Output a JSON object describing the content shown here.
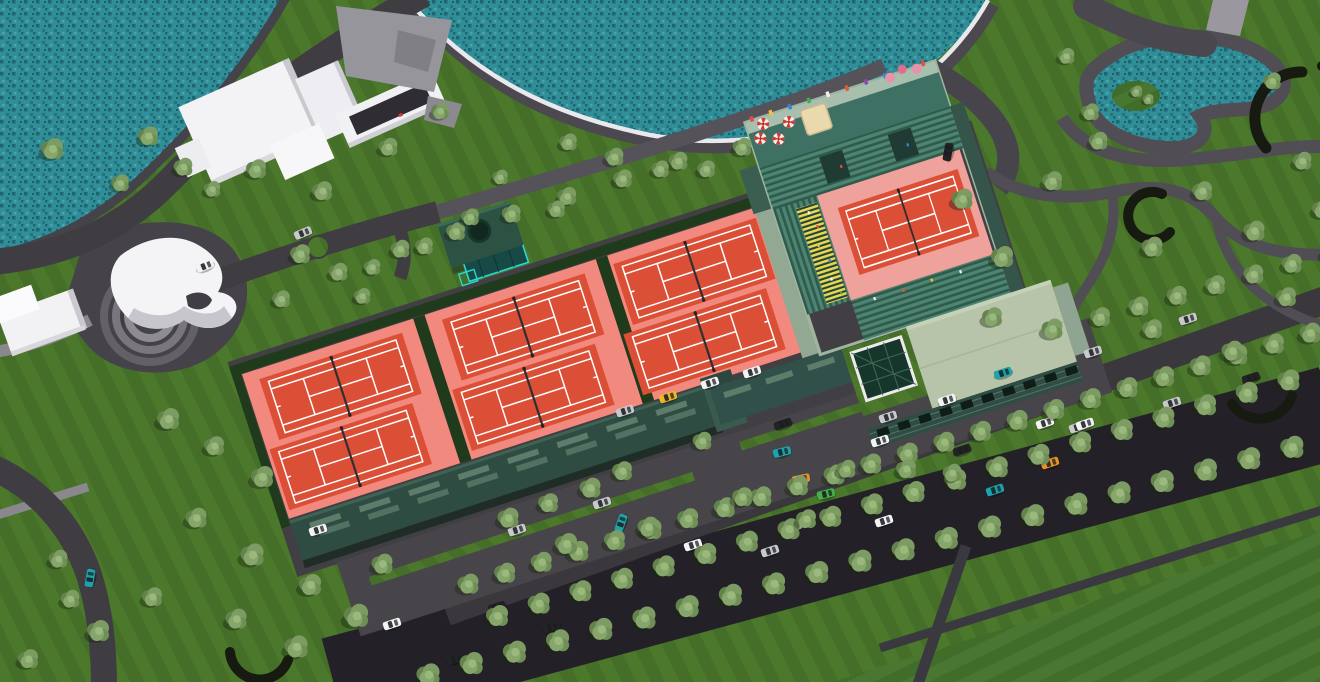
{
  "meta": {
    "description": "Aerial 3D architectural rendering of a lakeside tennis club complex",
    "view": "bird's-eye perspective, no visible text"
  },
  "palette": {
    "lawn": "#4c782c",
    "lawn-dark": "#456f28",
    "water": "#2f8e98",
    "water-dark": "#206570",
    "water-light": "#49a4ab",
    "pad": "#f2897e",
    "stadium-pad": "#efa19b",
    "court-red": "#dc4f37",
    "line": "#ffffff",
    "road": "#3f3d42",
    "boulevard": "#232127",
    "service": "#3a383d",
    "path": "#56525a",
    "path-light": "#9a989e",
    "walk": "#4b494f",
    "curb": "#e9e9ed",
    "plaza": "#454349",
    "hedge": "#203a1c",
    "arc": "#161a10",
    "stand": "#47806e",
    "terrace": "#3e7163",
    "terrace-walk": "#a9bfae",
    "stair": "#e7d84f",
    "roof-pale": "#b7c4a9",
    "facade": "#2f4d44",
    "indoor-roof": "#2f4c42",
    "slat": "#5d7c6a",
    "wall-light": "#93a893",
    "skylight": "#17362b",
    "teal": "#29d8d2",
    "white-bldg": "#f3f3f5",
    "white-shade": "#c9c9cf",
    "concrete": "#96959b",
    "tent": "#ead9ac",
    "car_colors": {
      "w": "#f2f3f5",
      "s": "#c8c9ce",
      "b": "#232327",
      "t": "#1ba4ac",
      "o": "#e8912a",
      "y": "#f0b42a",
      "g": "#43b04a"
    }
  },
  "scene": {
    "courts": {
      "outdoor_pads": 3,
      "courts_per_pad": 2,
      "outdoor_courts": 6,
      "stadium_courts": 1,
      "total_courts": 7
    },
    "water_features": [
      "large lake top",
      "corner lake top-left",
      "kidney pond with island top-right"
    ],
    "buildings": [
      "white villa cluster",
      "white sculptural pavilion with ring steps",
      "gray service slab",
      "indoor courts hall",
      "green-roof clubhouse with pyramid skylight",
      "entrance pavilion with round roof opening",
      "stadium with teal stands"
    ],
    "stadium": {
      "flag_colors": [
        "#e64b3c",
        "#f2c335",
        "#2e86d4",
        "#3fae4a",
        "#f0eff2",
        "#e2572f",
        "#8e44ad",
        "#2e86d4",
        "#f2c335",
        "#e64b3c"
      ],
      "umbrellas": [
        [
          826,
          168
        ],
        [
          843,
          174
        ],
        [
          858,
          161
        ],
        [
          833,
          155
        ]
      ],
      "flower_pots": [
        [
          968,
          150
        ],
        [
          982,
          146
        ],
        [
          996,
          150
        ]
      ],
      "crowd": [
        [
          848,
          252,
          "#f2f3f5"
        ],
        [
          852,
          268,
          "#e64b3c"
        ],
        [
          847,
          286,
          "#f2c335"
        ],
        [
          853,
          304,
          "#2e86d4"
        ],
        [
          849,
          322,
          "#f2f3f5"
        ],
        [
          854,
          338,
          "#3fae4a"
        ],
        [
          884,
          354,
          "#f2f3f5"
        ],
        [
          914,
          355,
          "#e2572f"
        ],
        [
          944,
          354,
          "#f2c335"
        ],
        [
          974,
          355,
          "#f2f3f5"
        ],
        [
          893,
          218,
          "#e64b3c"
        ],
        [
          963,
          218,
          "#2e86d4"
        ]
      ]
    },
    "tree_rows": [
      {
        "from": [
          497,
          617
        ],
        "to": [
          1330,
          369
        ],
        "n": 21,
        "s": 1.0
      },
      {
        "from": [
          428,
          676
        ],
        "to": [
          1335,
          437
        ],
        "n": 22,
        "s": 1.05
      },
      {
        "from": [
          468,
          585
        ],
        "to": [
          1310,
          334
        ],
        "n": 24,
        "s": 0.95
      },
      {
        "from": [
          400,
          250
        ],
        "to": [
          678,
          162
        ],
        "n": 6,
        "s": 0.85
      },
      {
        "from": [
          1100,
          318
        ],
        "to": [
          1330,
          254
        ],
        "n": 7,
        "s": 0.9
      }
    ],
    "trees_scatter": [
      [
        52,
        150,
        1
      ],
      [
        148,
        137,
        0.9
      ],
      [
        183,
        168,
        0.85
      ],
      [
        256,
        170,
        0.9
      ],
      [
        322,
        192,
        0.9
      ],
      [
        388,
        148,
        0.85
      ],
      [
        440,
        112,
        0.8
      ],
      [
        300,
        255,
        0.9
      ],
      [
        338,
        273,
        0.85
      ],
      [
        281,
        300,
        0.8
      ],
      [
        362,
        297,
        0.75
      ],
      [
        470,
        218,
        0.8
      ],
      [
        424,
        247,
        0.8
      ],
      [
        372,
        268,
        0.75
      ],
      [
        120,
        184,
        0.8
      ],
      [
        212,
        190,
        0.75
      ],
      [
        568,
        143,
        0.8
      ],
      [
        614,
        158,
        0.85
      ],
      [
        660,
        170,
        0.8
      ],
      [
        742,
        148,
        0.85
      ],
      [
        706,
        170,
        0.8
      ],
      [
        168,
        420,
        1
      ],
      [
        214,
        447,
        0.9
      ],
      [
        262,
        478,
        1
      ],
      [
        196,
        519,
        0.95
      ],
      [
        252,
        556,
        1.05
      ],
      [
        310,
        586,
        1
      ],
      [
        356,
        617,
        1.1
      ],
      [
        296,
        648,
        1.05
      ],
      [
        236,
        620,
        0.95
      ],
      [
        152,
        598,
        0.9
      ],
      [
        98,
        632,
        1
      ],
      [
        382,
        565,
        0.95
      ],
      [
        58,
        560,
        0.85
      ],
      [
        28,
        660,
        0.9
      ],
      [
        70,
        600,
        0.85
      ],
      [
        508,
        519,
        0.95
      ],
      [
        548,
        504,
        0.9
      ],
      [
        590,
        489,
        0.95
      ],
      [
        566,
        545,
        1
      ],
      [
        622,
        472,
        0.9
      ],
      [
        702,
        442,
        0.85
      ],
      [
        648,
        528,
        0.95
      ],
      [
        742,
        498,
        0.9
      ],
      [
        806,
        520,
        0.9
      ],
      [
        846,
        470,
        0.85
      ],
      [
        906,
        470,
        0.9
      ],
      [
        952,
        474,
        0.85
      ],
      [
        962,
        200,
        0.95
      ],
      [
        1002,
        258,
        1
      ],
      [
        1052,
        182,
        0.9
      ],
      [
        1098,
        142,
        0.85
      ],
      [
        1152,
        248,
        0.95
      ],
      [
        1202,
        192,
        0.9
      ],
      [
        1254,
        232,
        0.95
      ],
      [
        1286,
        298,
        0.9
      ],
      [
        1232,
        352,
        0.95
      ],
      [
        1152,
        330,
        0.9
      ],
      [
        1052,
        330,
        0.95
      ],
      [
        992,
        318,
        0.9
      ],
      [
        1302,
        162,
        0.85
      ],
      [
        1272,
        82,
        0.8
      ],
      [
        1066,
        57,
        0.75
      ],
      [
        1090,
        113,
        0.8
      ],
      [
        1322,
        210,
        0.9
      ],
      [
        1136,
        92,
        0.55
      ],
      [
        1148,
        100,
        0.5
      ],
      [
        500,
        178,
        0.7
      ],
      [
        556,
        210,
        0.8
      ]
    ],
    "cars": [
      [
        205,
        266,
        -23,
        "w"
      ],
      [
        303,
        233,
        -23,
        "s"
      ],
      [
        948,
        152,
        -80,
        "b"
      ],
      [
        318,
        530,
        -17,
        "w"
      ],
      [
        90,
        578,
        -80,
        "t"
      ],
      [
        625,
        411,
        -18,
        "s"
      ],
      [
        668,
        397,
        -18,
        "y"
      ],
      [
        710,
        383,
        -18,
        "w"
      ],
      [
        752,
        372,
        -18,
        "w"
      ],
      [
        783,
        424,
        -18,
        "b"
      ],
      [
        782,
        452,
        -14,
        "t"
      ],
      [
        801,
        479,
        -12,
        "o"
      ],
      [
        826,
        494,
        -14,
        "g"
      ],
      [
        602,
        503,
        -18,
        "s"
      ],
      [
        621,
        523,
        -70,
        "t"
      ],
      [
        517,
        530,
        -18,
        "s"
      ],
      [
        693,
        545,
        -18,
        "w"
      ],
      [
        770,
        551,
        -18,
        "s"
      ],
      [
        793,
        527,
        -18,
        "w"
      ],
      [
        884,
        521,
        -18,
        "w"
      ],
      [
        455,
        659,
        -18,
        "b"
      ],
      [
        392,
        624,
        -18,
        "w"
      ],
      [
        551,
        627,
        -18,
        "b"
      ],
      [
        497,
        607,
        -18,
        "b"
      ],
      [
        888,
        417,
        -18,
        "s"
      ],
      [
        880,
        441,
        -18,
        "w"
      ],
      [
        962,
        450,
        -18,
        "b"
      ],
      [
        1003,
        373,
        -18,
        "t"
      ],
      [
        947,
        400,
        -18,
        "w"
      ],
      [
        1045,
        423,
        -18,
        "w"
      ],
      [
        1078,
        427,
        -18,
        "s"
      ],
      [
        1050,
        463,
        -18,
        "o"
      ],
      [
        995,
        490,
        -18,
        "t"
      ],
      [
        1093,
        352,
        -18,
        "s"
      ],
      [
        1188,
        319,
        -18,
        "s"
      ],
      [
        1251,
        378,
        -18,
        "b"
      ],
      [
        1172,
        403,
        -18,
        "s"
      ],
      [
        1085,
        424,
        -18,
        "w"
      ]
    ]
  }
}
